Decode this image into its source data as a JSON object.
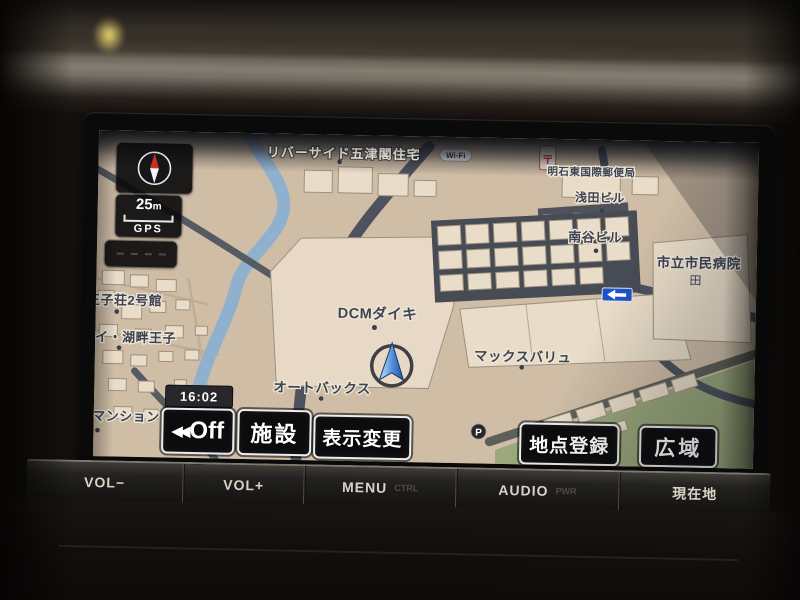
{
  "map_status": {
    "scale_value": "25",
    "scale_unit": "m",
    "gps_label": "GPS",
    "clock": "16:02",
    "wifi_label": "Wi-Fi"
  },
  "toolbar": {
    "buttons": [
      {
        "id": "off",
        "prefix": "◀◀",
        "label": "Off"
      },
      {
        "id": "facility",
        "label": "施設"
      },
      {
        "id": "display-change",
        "label": "表示変更"
      },
      {
        "id": "point-register",
        "label": "地点登録"
      },
      {
        "id": "wide-area",
        "label": "広域"
      }
    ]
  },
  "hardware": {
    "buttons": [
      {
        "label": "VOL−",
        "sub": ""
      },
      {
        "label": "VOL+",
        "sub": ""
      },
      {
        "label": "MENU",
        "sub": "CTRL"
      },
      {
        "label": "AUDIO",
        "sub": "PWR"
      },
      {
        "label": "現在地",
        "sub": ""
      }
    ]
  },
  "map": {
    "labels": [
      {
        "id": "riverside-housing",
        "text": "リバーサイド五津閣住宅"
      },
      {
        "id": "post-office",
        "text": "明石東国際郵便局"
      },
      {
        "id": "asada-building",
        "text": "浅田ビル"
      },
      {
        "id": "minamitani-building",
        "text": "南谷ビル"
      },
      {
        "id": "city-hospital",
        "text": "市立市民病院"
      },
      {
        "id": "ojiso-no2",
        "text": "王子荘2号館"
      },
      {
        "id": "kohan-oji",
        "text": "ーアイ・湖畔王子"
      },
      {
        "id": "dcm-daiki",
        "text": "DCMダイキ"
      },
      {
        "id": "max-valu",
        "text": "マックスバリュ"
      },
      {
        "id": "autobacs",
        "text": "オートバックス"
      },
      {
        "id": "mansion",
        "text": "イマンション"
      }
    ],
    "symbols": {
      "parking": "P",
      "post_mark": "〒",
      "hospital_mark": "田"
    },
    "colors": {
      "land": "#cfbda6",
      "building": "#e9dcc8",
      "river": "#8fb1cd",
      "road_major": "#4d525e",
      "green_area": "#9aa87b",
      "one_way_sign": "#1f52c8"
    }
  }
}
